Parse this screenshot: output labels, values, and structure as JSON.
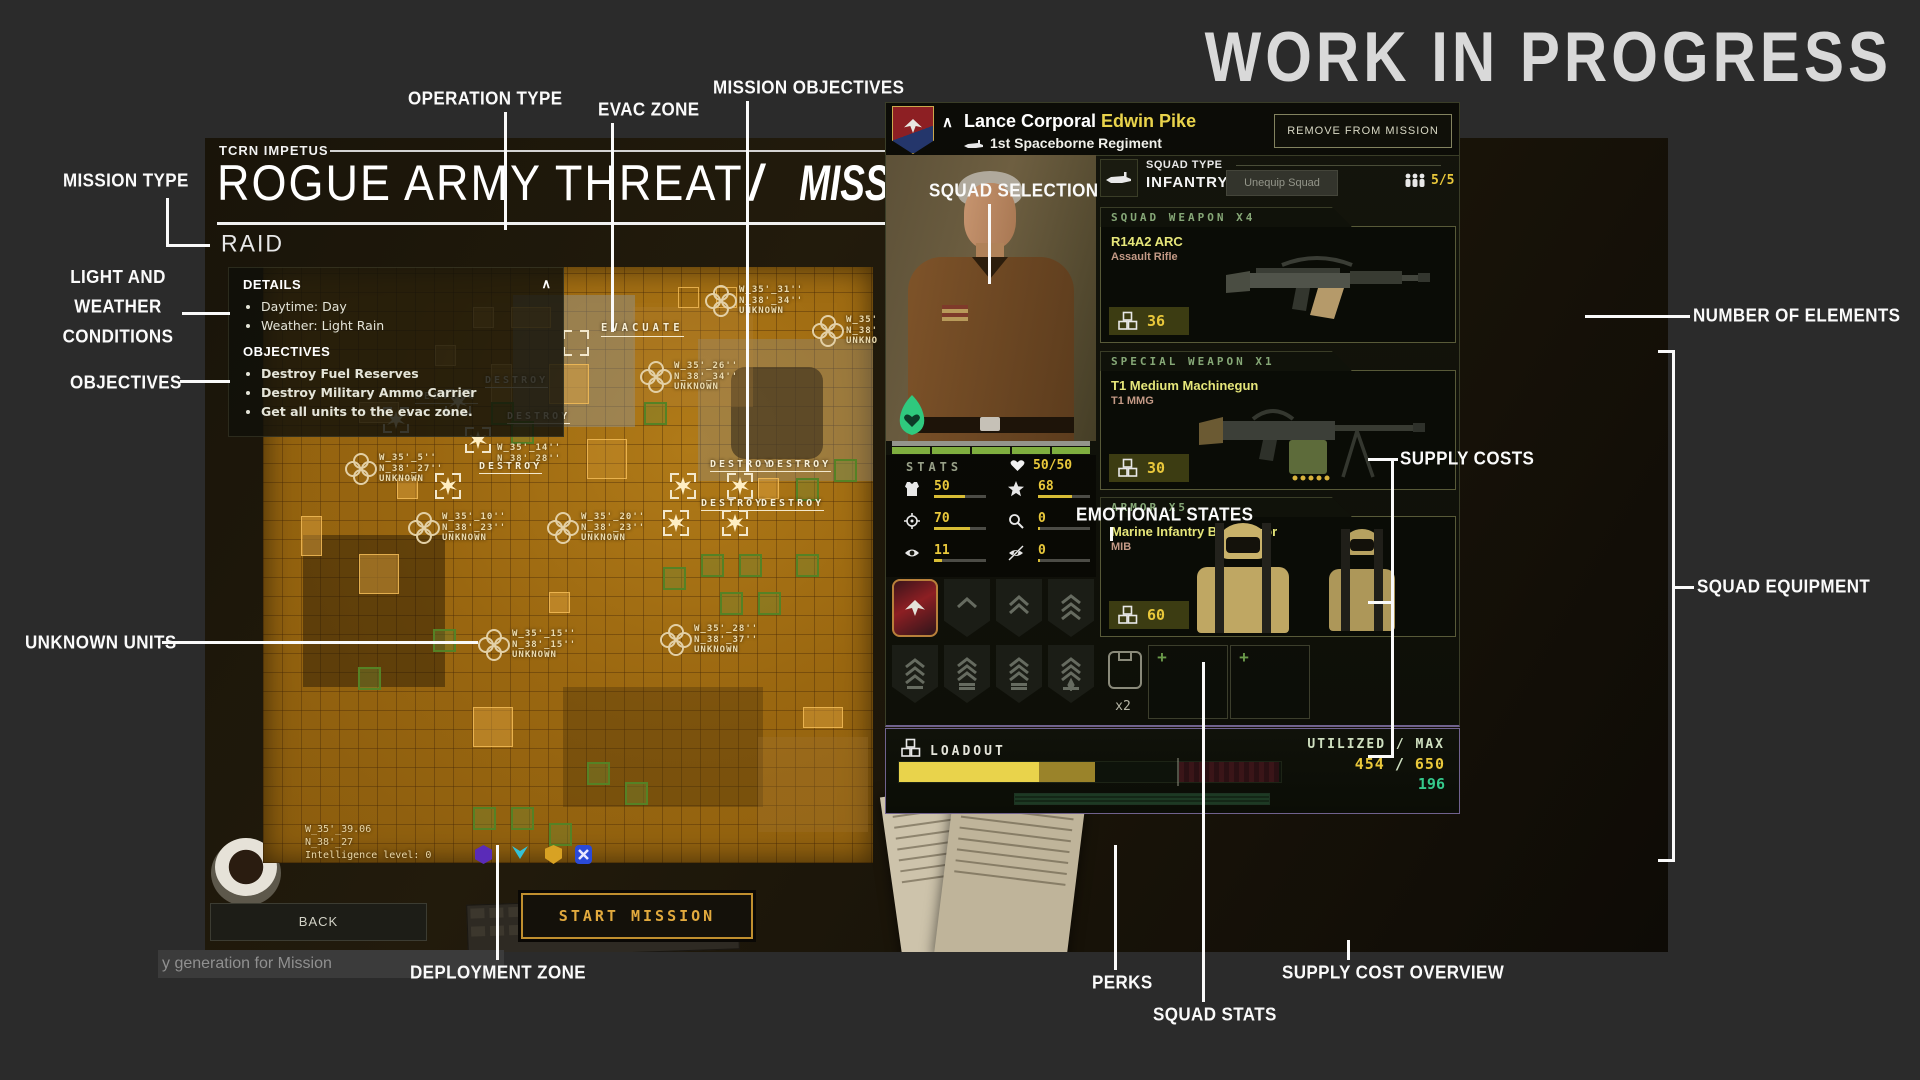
{
  "watermark": "WORK IN PROGRESS",
  "colors": {
    "accent_yellow": "#e9c83b",
    "map_orange": "#a06a10",
    "hp_green": "#7fae3f",
    "remaining_green": "#35c98c",
    "start_orange": "#e2aa3e"
  },
  "annotations": {
    "mission_type": "MISSION TYPE",
    "operation_type": "OPERATION TYPE",
    "evac_zone": "EVAC ZONE",
    "mission_objectives": "MISSION OBJECTIVES",
    "squad_selection": "SQUAD SELECTION",
    "light_weather": "LIGHT AND\nWEATHER\nCONDITIONS",
    "objectives": "OBJECTIVES",
    "unknown_units": "UNKNOWN UNITS",
    "deployment_zone": "DEPLOYMENT ZONE",
    "emotional_states": "EMOTIONAL STATES",
    "perks": "PERKS",
    "squad_stats": "SQUAD STATS",
    "supply_cost_overview": "SUPPLY COST OVERVIEW",
    "supply_costs": "SUPPLY COSTS",
    "number_of_elements": "NUMBER OF ELEMENTS",
    "squad_equipment": "SQUAD EQUIPMENT"
  },
  "mission": {
    "campaign": "TCRN IMPETUS",
    "title": "ROGUE ARMY THREAT",
    "divider": "/",
    "subtitle": "MISSION PREP",
    "type": "RAID",
    "details_header": "DETAILS",
    "details": [
      "Daytime: Day",
      "Weather: Light Rain"
    ],
    "objectives_header": "OBJECTIVES",
    "objectives": [
      "Destroy Fuel Reserves",
      "Destroy Military Ammo Carrier",
      "Get all units to the evac zone."
    ],
    "map": {
      "evacuate_label": "EVACUATE",
      "destroy_label": "DESTROY",
      "markers": [
        {
          "l1": "W_35'_31''",
          "l2": "N_38'_34''",
          "l3": "UNKNOWN"
        },
        {
          "l1": "W_35'",
          "l2": "N_38'",
          "l3": "UNKNO"
        },
        {
          "l1": "W_35'_26''",
          "l2": "N_38'_34''",
          "l3": "UNKNOWN"
        },
        {
          "l1": "W_35'_5''",
          "l2": "N_38'_27''",
          "l3": "UNKNOWN"
        },
        {
          "l1": "W_35'_14''",
          "l2": "N_38'_28''",
          "l3": ""
        },
        {
          "l1": "W_35'_10''",
          "l2": "N_38'_23''",
          "l3": "UNKNOWN"
        },
        {
          "l1": "W_35'_20''",
          "l2": "N_38'_23''",
          "l3": "UNKNOWN"
        },
        {
          "l1": "W_35'_15''",
          "l2": "N_38'_15''",
          "l3": "UNKNOWN"
        },
        {
          "l1": "W_35'_28''",
          "l2": "N_38'_37''",
          "l3": "UNKNOWN"
        }
      ],
      "coords_line1": "W_35'_39.06",
      "coords_line2": "N_38'_27",
      "intel": "Intelligence level: 0"
    },
    "back_label": "BACK",
    "start_label": "START MISSION"
  },
  "footer_note": "y generation for Mission",
  "squad": {
    "rank": "Lance Corporal",
    "name": "Edwin Pike",
    "regiment": "1st Spaceborne Regiment",
    "remove_button": "REMOVE FROM MISSION",
    "squad_type_label": "SQUAD TYPE",
    "squad_type": "INFANTRY",
    "unequip_button": "Unequip Squad",
    "elements": "5/5",
    "weapon_panel": {
      "header": "SQUAD WEAPON X4",
      "name": "R14A2 ARC",
      "subtitle": "Assault Rifle",
      "cost": "36"
    },
    "special_panel": {
      "header": "SPECIAL WEAPON X1",
      "name": "T1 Medium Machinegun",
      "subtitle": "T1 MMG",
      "cost": "30"
    },
    "armor_panel": {
      "header": "ARMOR X5",
      "name": "Marine Infantry Bodyarmor",
      "subtitle": "MIB",
      "cost": "60"
    },
    "extra_slots": {
      "multiplier": "x2",
      "plus": "+"
    },
    "stats": {
      "header": "STATS",
      "hp": "50/50",
      "armor": "50",
      "accuracy": "70",
      "vision": "11",
      "experience": "68",
      "detection": "0",
      "stealth": "0"
    },
    "loadout": {
      "header": "LOADOUT",
      "utilized_label": "UTILIZED / MAX",
      "utilized": "454",
      "separator": "/",
      "max": "650",
      "remaining": "196"
    }
  },
  "glyphs": {
    "chevron_up": "∧",
    "check": "✓",
    "bullet": "•"
  }
}
